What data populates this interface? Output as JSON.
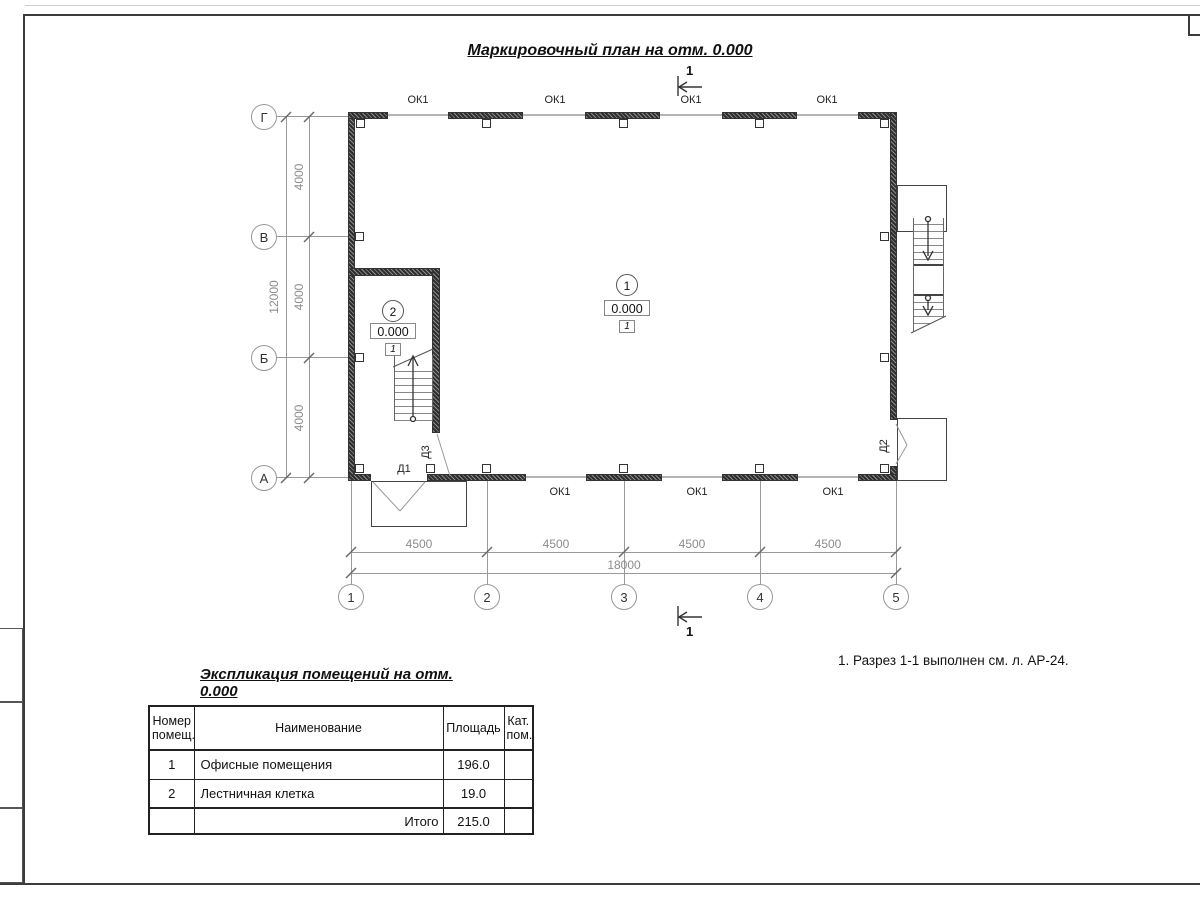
{
  "drawing": {
    "title": "Маркировочный план на отм. 0.000",
    "note": "1. Разрез 1-1 выполнен см. л. АР-24."
  },
  "section_mark": {
    "number": "1"
  },
  "axes": {
    "rows": [
      "Г",
      "В",
      "Б",
      "А"
    ],
    "cols": [
      "1",
      "2",
      "3",
      "4",
      "5"
    ]
  },
  "dims": {
    "v_segments": [
      "4000",
      "4000",
      "4000"
    ],
    "v_total": "12000",
    "h_segments": [
      "4500",
      "4500",
      "4500",
      "4500"
    ],
    "h_total": "18000"
  },
  "windows": {
    "top": [
      "ОК1",
      "ОК1",
      "ОК1",
      "ОК1"
    ],
    "bottom": [
      "ОК1",
      "ОК1",
      "ОК1"
    ]
  },
  "doors": {
    "d1": "Д1",
    "d2": "Д2",
    "d3": "Д3"
  },
  "rooms": [
    {
      "number": "1",
      "elevation": "0.000",
      "floor_type": "1"
    },
    {
      "number": "2",
      "elevation": "0.000",
      "floor_type": "1"
    }
  ],
  "table": {
    "title": "Экспликация помещений на отм. 0.000",
    "headers": [
      "Номер помещ.",
      "Наименование",
      "Площадь",
      "Кат. пом."
    ],
    "rows": [
      {
        "num": "1",
        "name": "Офисные помещения",
        "area": "196.0",
        "cat": ""
      },
      {
        "num": "2",
        "name": "Лестничная клетка",
        "area": "19.0",
        "cat": ""
      }
    ],
    "total_label": "Итого",
    "total_value": "215.0"
  }
}
